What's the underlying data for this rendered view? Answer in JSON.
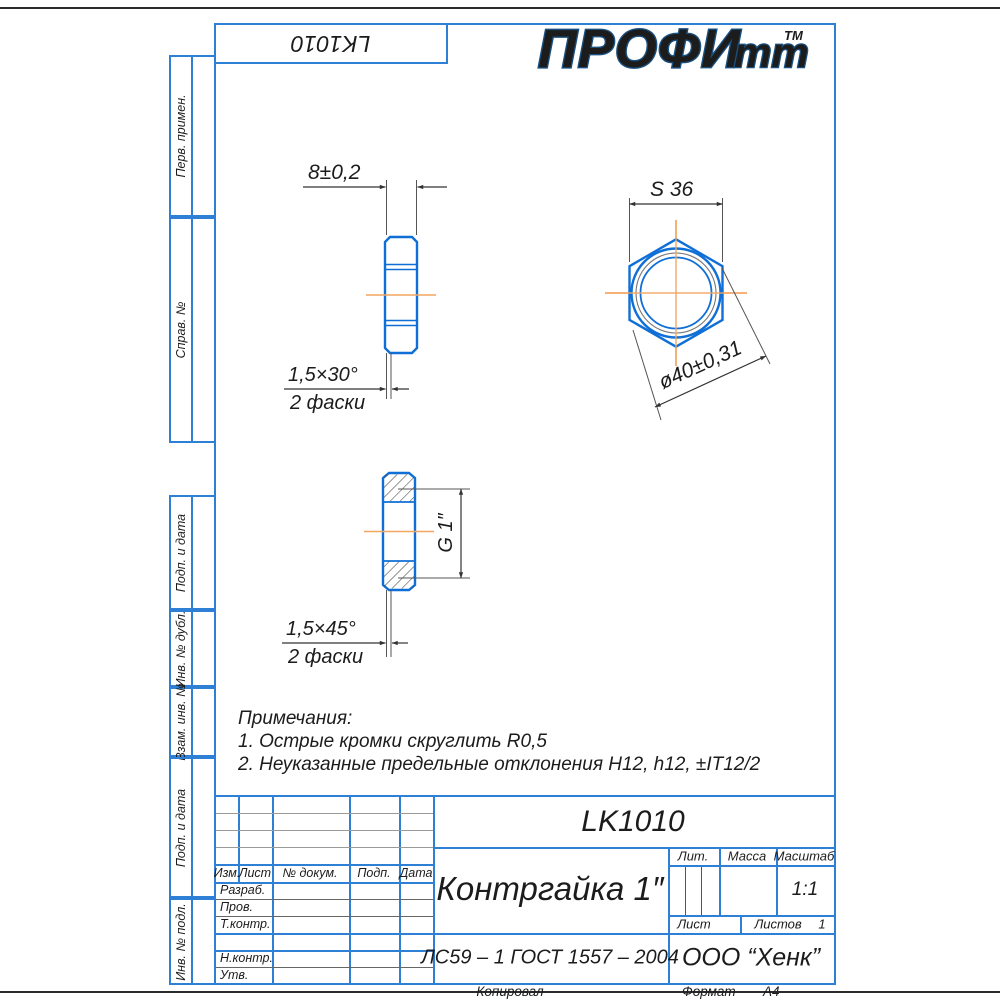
{
  "logo": {
    "main": "ПРОФИ",
    "small": "тт",
    "tm": "TM"
  },
  "top_box": {
    "designation": "LK1010"
  },
  "margin_labels": [
    "Перв. примен.",
    "Справ. №",
    "Подп. и дата",
    "Инв. № дубл.",
    "Взам. инв. №",
    "Подп. и дата",
    "Инв. № подл."
  ],
  "views": {
    "side": {
      "width_dim": "8±0,2",
      "chamfer": "1,5×30°",
      "chamfer_count": "2 фаски"
    },
    "front": {
      "across_flats": "S 36",
      "outer_diameter": "ø40±0,31"
    },
    "section": {
      "thread": "G 1″",
      "chamfer": "1,5×45°",
      "chamfer_count": "2 фаски"
    }
  },
  "notes": {
    "title": "Примечания:",
    "items": [
      "1. Острые кромки скруглить R0,5",
      "2. Неуказанные предельные отклонения H12, h12, ±IT12/2"
    ]
  },
  "title_block": {
    "designation": "LK1010",
    "part_name": "Контргайка 1″",
    "material": "ЛС59 – 1 ГОСТ 1557 – 2004",
    "company": "ООО “Хенк”",
    "lit_label": "Лит.",
    "mass_label": "Масса",
    "scale_label": "Масштаб",
    "scale_value": "1:1",
    "sheet_label": "Лист",
    "sheets_label": "Листов",
    "sheets_value": "1",
    "rev_headers": [
      "Изм.",
      "Лист",
      "№ докум.",
      "Подп.",
      "Дата"
    ],
    "roles": [
      "Разраб.",
      "Пров.",
      "Т.контр.",
      "Н.контр.",
      "Утв."
    ]
  },
  "footer": {
    "copied": "Копировал",
    "format_label": "Формат",
    "format_value": "А4"
  },
  "colors": {
    "frame": "#2e7fd6",
    "part_line": "#0f6fd6",
    "center_line": "#f2a661",
    "logo": "#1a5080"
  }
}
